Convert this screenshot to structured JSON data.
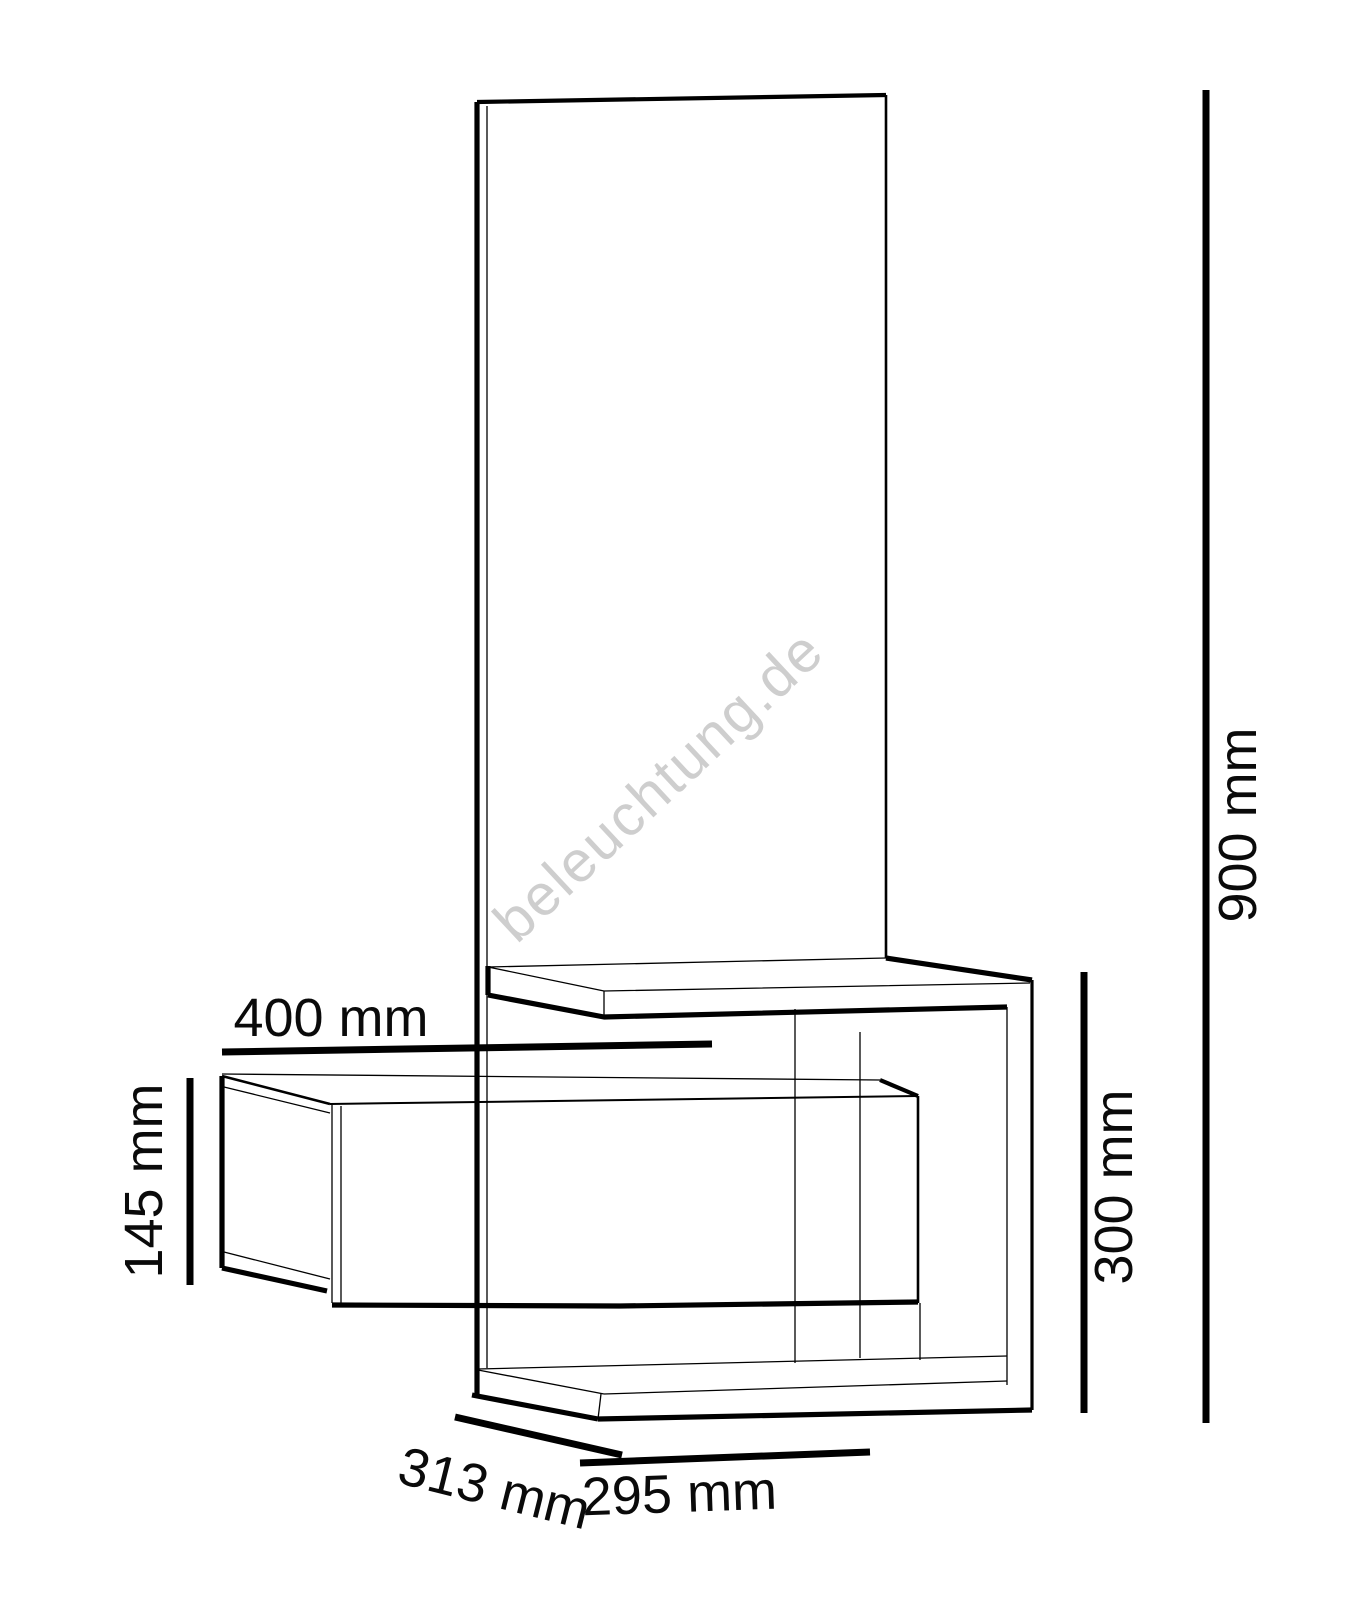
{
  "drawing": {
    "type": "furniture-dimension-diagram",
    "watermark": "beleuchtung.de",
    "line_color": "#000000",
    "watermark_color": "#c9c9c9",
    "background_color": "#ffffff"
  },
  "dimensions": {
    "drawer_width": {
      "label": "400 mm",
      "value": 400,
      "unit": "mm"
    },
    "drawer_height": {
      "label": "145 mm",
      "value": 145,
      "unit": "mm"
    },
    "total_height": {
      "label": "900 mm",
      "value": 900,
      "unit": "mm"
    },
    "frame_height": {
      "label": "300 mm",
      "value": 300,
      "unit": "mm"
    },
    "depth": {
      "label": "313 mm",
      "value": 313,
      "unit": "mm"
    },
    "frame_width": {
      "label": "295 mm",
      "value": 295,
      "unit": "mm"
    }
  }
}
